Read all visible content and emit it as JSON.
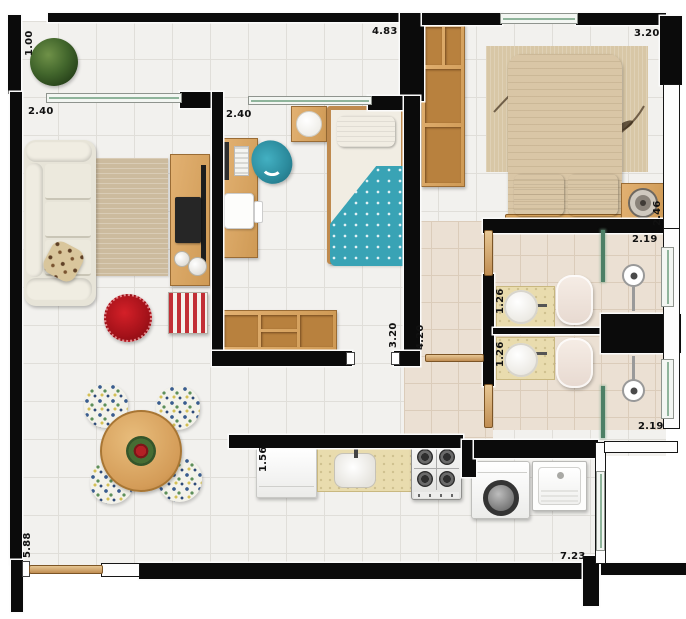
{
  "plan": {
    "title": "apartment-floor-plan-top-view",
    "dimension_labels": {
      "balcony_depth": "1.00",
      "living_width": "2.40",
      "living_length": "5.88",
      "bedroom2_width": "2.40",
      "bedroom2_length": "3.20",
      "hall_length": "4.20",
      "top_span": "4.83",
      "master_width": "3.20",
      "master_depth": "2.46",
      "bath_suite_width": "2.19",
      "bath_suite_sink_depth": "1.26",
      "bath_social_sink_depth": "1.26",
      "bath_social_width": "2.19",
      "kitchen_depth": "1.56",
      "bottom_span": "7.23"
    },
    "fixtures": [
      "potted-plant",
      "sofa",
      "leopard-pillow",
      "area-rug",
      "tv-stand",
      "tv",
      "soundbar",
      "speaker",
      "red-pouf",
      "striped-ottoman",
      "round-dining-table",
      "floral-chair",
      "flower-centerpiece",
      "entry-door",
      "desk",
      "laptop",
      "keyboard",
      "monitor",
      "office-chair",
      "side-table",
      "single-bed",
      "single-bed-pillow",
      "polka-dot-blanket",
      "low-shelf",
      "wardrobe",
      "bedroom-rug",
      "double-bed",
      "bed-pillow",
      "foot-bench",
      "nightstand",
      "table-lamp",
      "vanity-counter",
      "washbasin",
      "faucet",
      "toilet",
      "shower-glass",
      "shower-head",
      "fridge",
      "kitchen-counter",
      "kitchen-sink",
      "gas-stove",
      "washing-machine",
      "laundry-tub",
      "sliding-glass-door",
      "window"
    ],
    "palette": {
      "wall": "#0b0b0b",
      "floor_light": "#f2f1ee",
      "floor_warm": "#ebe0d3",
      "wood": "#d9a765",
      "door_wood": "#d3a86f",
      "accent_teal": "#39a3b5",
      "accent_red": "#ab1016",
      "glass_green": "#4d8066",
      "bed_beige": "#d8c5a5",
      "sofa_cream": "#e9e6da",
      "counter_granite": "#e9dcae"
    }
  }
}
